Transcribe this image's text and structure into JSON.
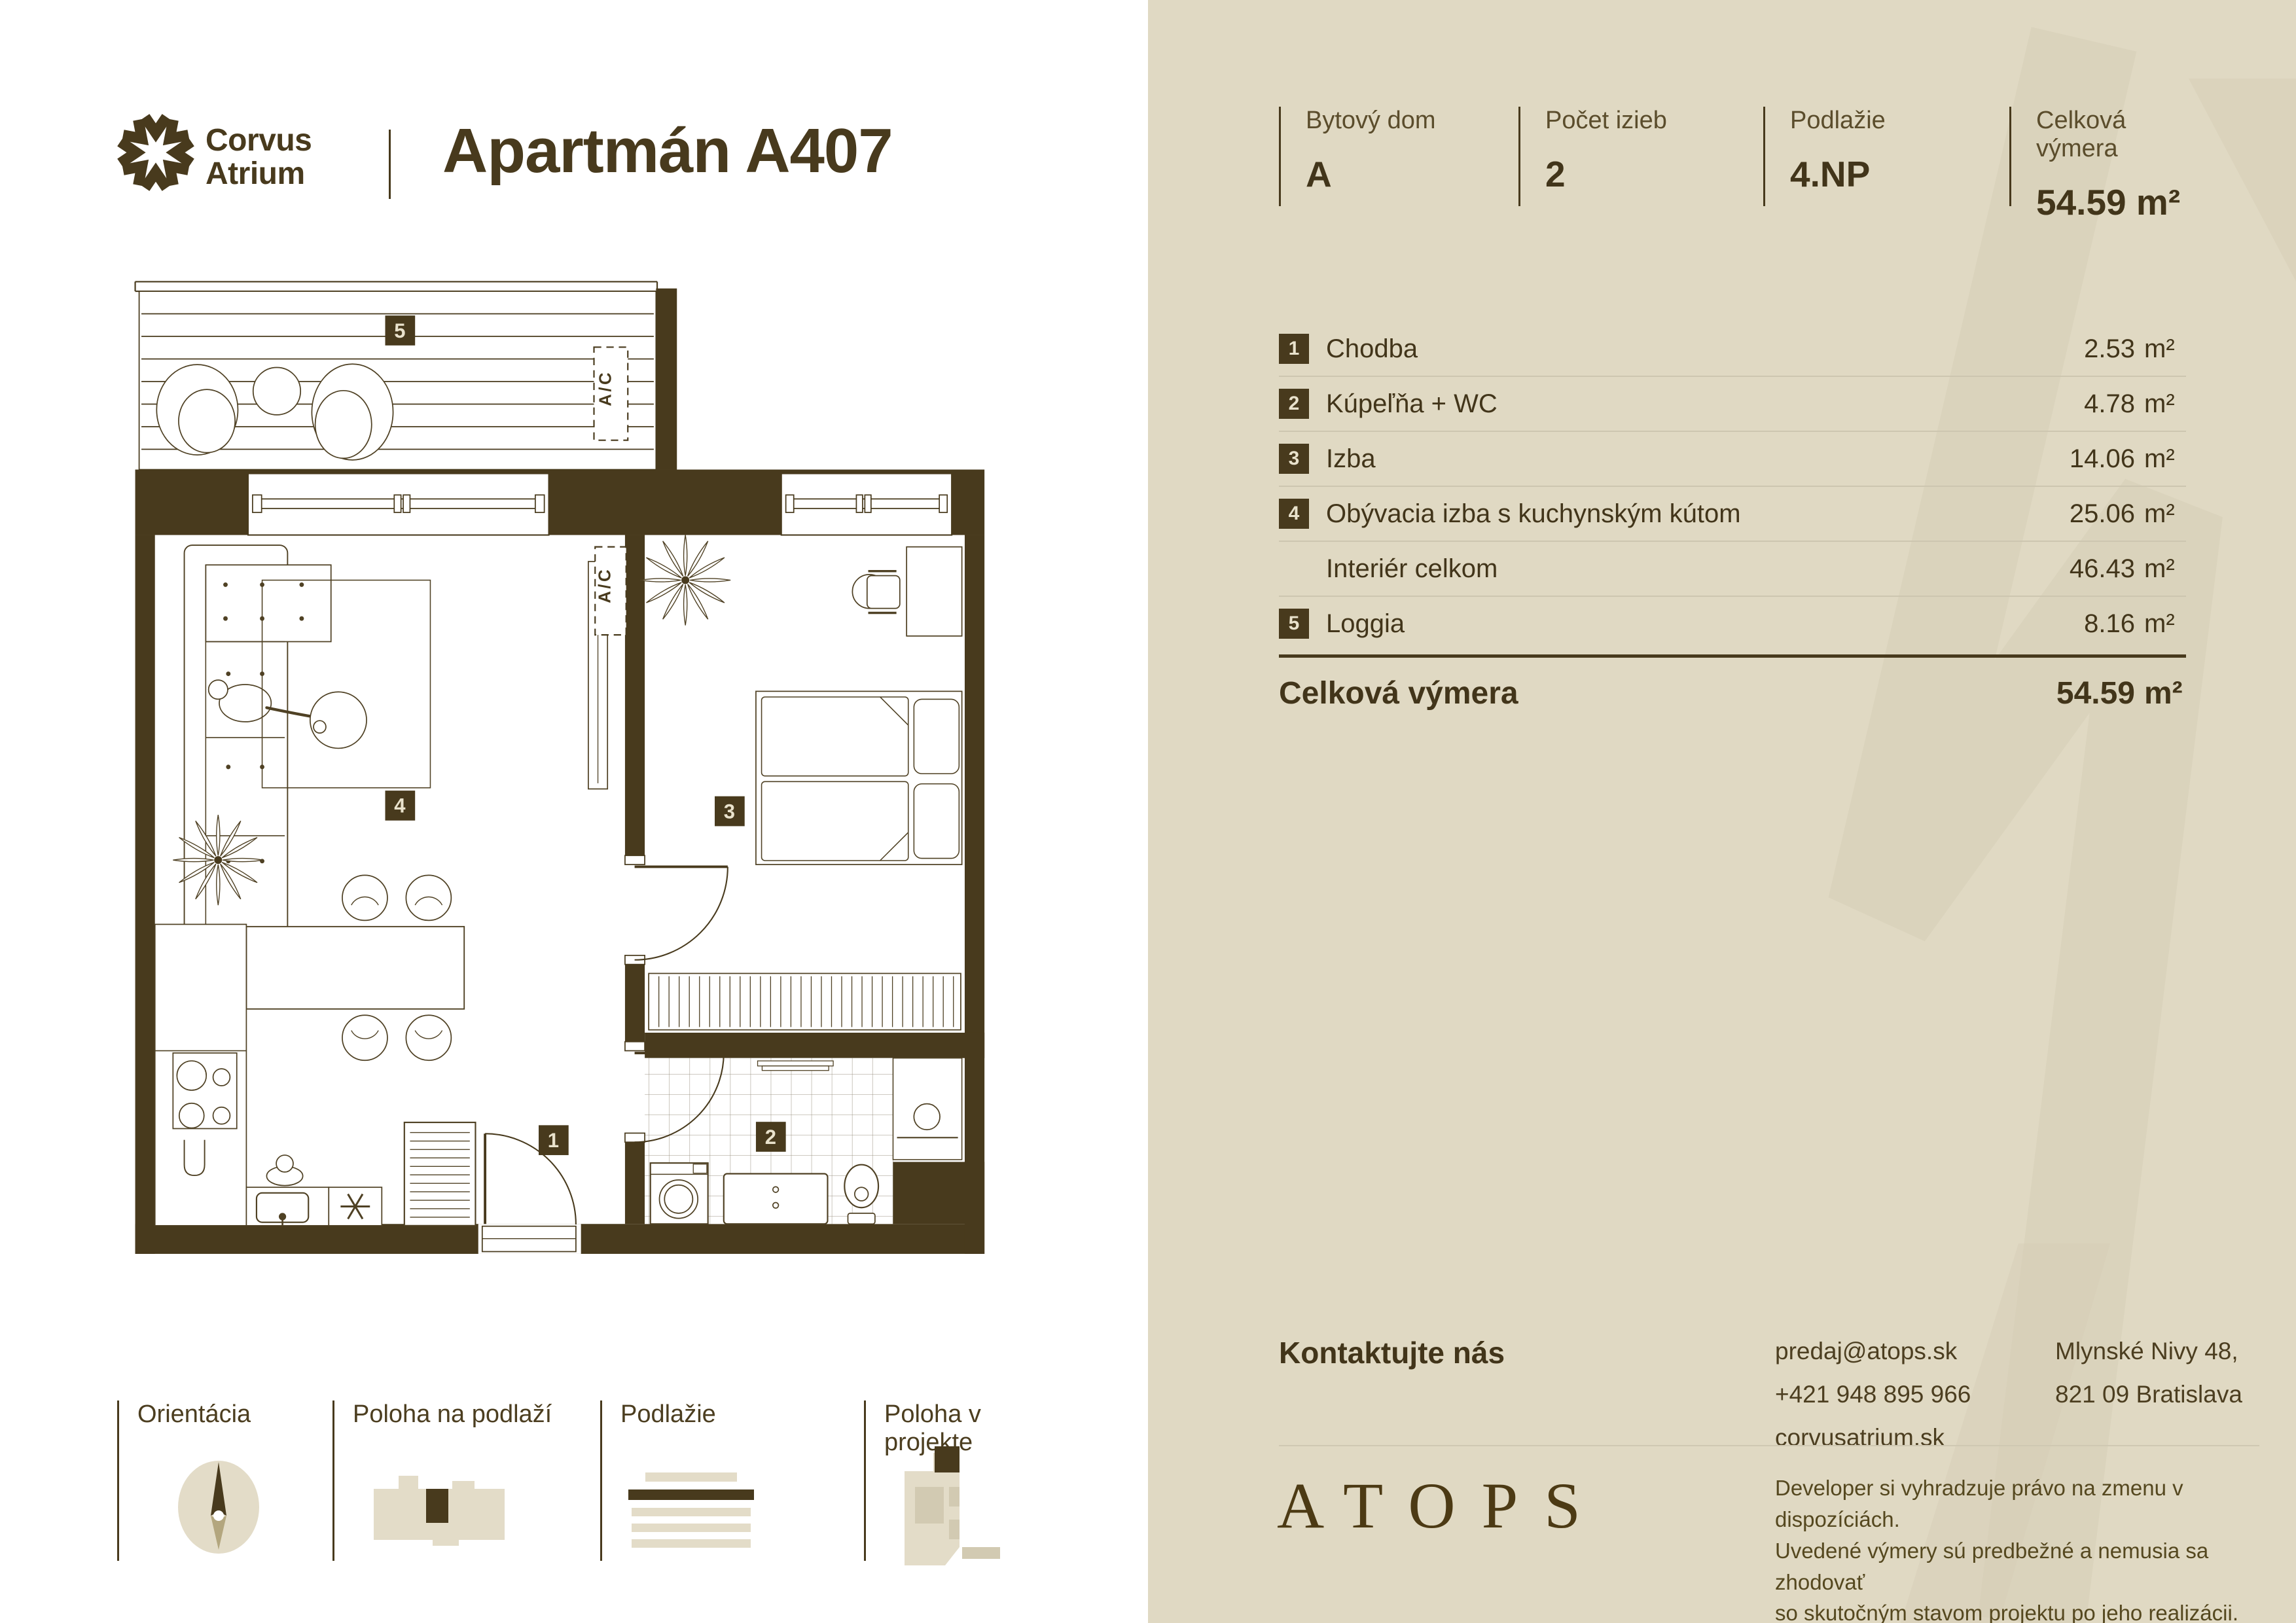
{
  "brand": {
    "line1": "Corvus",
    "line2": "Atrium"
  },
  "page_title": "Apartmán A407",
  "summary": {
    "items": [
      {
        "label": "Bytový dom",
        "value": "A"
      },
      {
        "label": "Počet izieb",
        "value": "2"
      },
      {
        "label": "Podlažie",
        "value": "4.NP"
      },
      {
        "label": "Celková výmera",
        "value": "54.59 m²"
      }
    ]
  },
  "rooms": {
    "rows": [
      {
        "num": "1",
        "label": "Chodba",
        "area": "2.53",
        "unit": "m²"
      },
      {
        "num": "2",
        "label": "Kúpeľňa + WC",
        "area": "4.78",
        "unit": "m²"
      },
      {
        "num": "3",
        "label": "Izba",
        "area": "14.06",
        "unit": "m²"
      },
      {
        "num": "4",
        "label": "Obývacia izba s kuchynským kútom",
        "area": "25.06",
        "unit": "m²"
      },
      {
        "num": "",
        "label": "Interiér celkom",
        "area": "46.43",
        "unit": "m²"
      },
      {
        "num": "5",
        "label": "Loggia",
        "area": "8.16",
        "unit": "m²"
      }
    ],
    "total": {
      "label": "Celková výmera",
      "area": "54.59",
      "unit": "m²"
    }
  },
  "contact": {
    "heading": "Kontaktujte nás",
    "email": "predaj@atops.sk",
    "phone": "+421 948 895 966",
    "web": "corvusatrium.sk",
    "address_line1": "Mlynské Nivy 48,",
    "address_line2": "821 09 Bratislava"
  },
  "developer": {
    "logo": "ATOPS",
    "disclaimer_line1": "Developer si vyhradzuje právo na zmenu v dispozíciách.",
    "disclaimer_line2": "Uvedené výmery sú predbežné a nemusia sa zhodovať",
    "disclaimer_line3": "so skutočným stavom projektu po jeho realizácii."
  },
  "legend": {
    "items": [
      {
        "label": "Orientácia"
      },
      {
        "label": "Poloha na podlaží"
      },
      {
        "label": "Podlažie"
      },
      {
        "label": "Poloha v projekte"
      }
    ]
  },
  "plan": {
    "ac_label": "A/C",
    "badges": {
      "b1": "1",
      "b2": "2",
      "b3": "3",
      "b4": "4",
      "b5": "5"
    }
  },
  "colors": {
    "accent": "#483a1d",
    "panel_bg": "#e0d9c3",
    "divider_light": "#cdc6b0",
    "watermark": "#d5cdb6",
    "badge_text": "#e9e2cc"
  }
}
